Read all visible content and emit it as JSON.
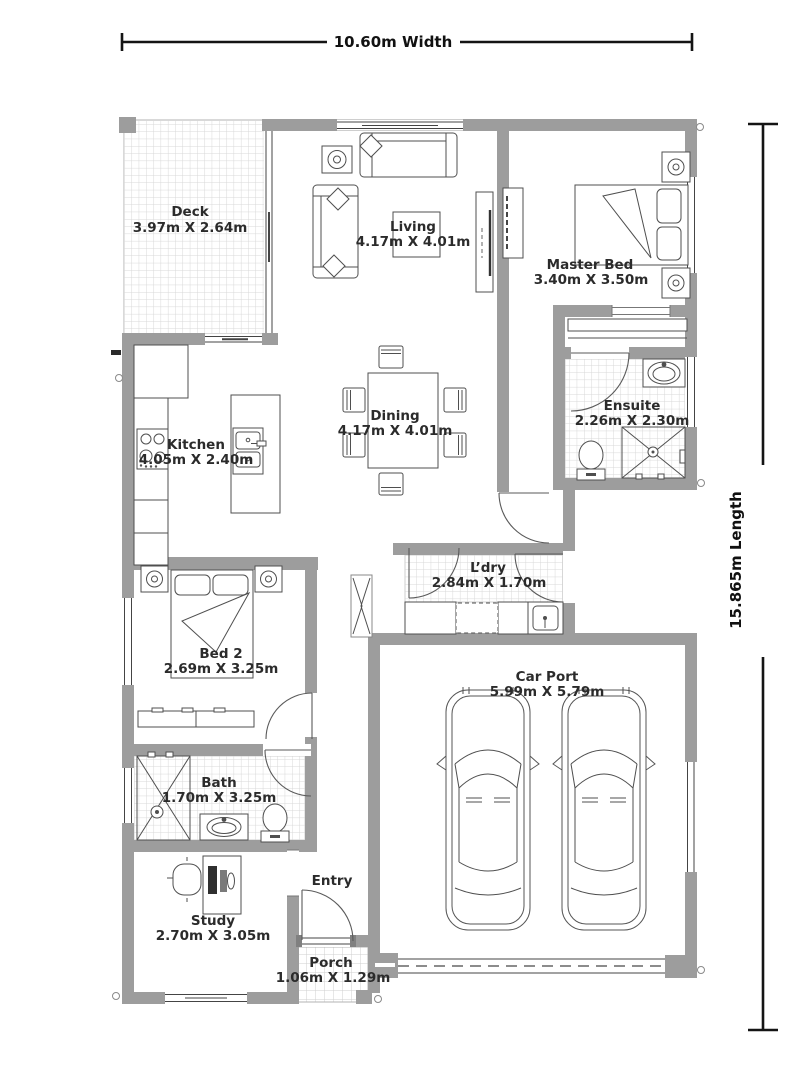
{
  "dimensions": {
    "width_label": "10.60m Width",
    "length_label": "15.865m Length"
  },
  "rooms": {
    "deck": {
      "name": "Deck",
      "size": "3.97m X 2.64m"
    },
    "living": {
      "name": "Living",
      "size": "4.17m X 4.01m"
    },
    "master": {
      "name": "Master Bed",
      "size": "3.40m X 3.50m"
    },
    "kitchen": {
      "name": "Kitchen",
      "size": "4.05m X 2.40m"
    },
    "dining": {
      "name": "Dining",
      "size": "4.17m X 4.01m"
    },
    "ensuite": {
      "name": "Ensuite",
      "size": "2.26m X 2.30m"
    },
    "laundry": {
      "name": "L’dry",
      "size": "2.84m X 1.70m"
    },
    "bed2": {
      "name": "Bed 2",
      "size": "2.69m X 3.25m"
    },
    "carport": {
      "name": "Car Port",
      "size": "5.99m X 5.79m"
    },
    "bath": {
      "name": "Bath",
      "size": "1.70m X 3.25m"
    },
    "study": {
      "name": "Study",
      "size": "2.70m X 3.05m"
    },
    "entry": {
      "name": "Entry"
    },
    "porch": {
      "name": "Porch",
      "size": "1.06m X 1.29m"
    }
  }
}
